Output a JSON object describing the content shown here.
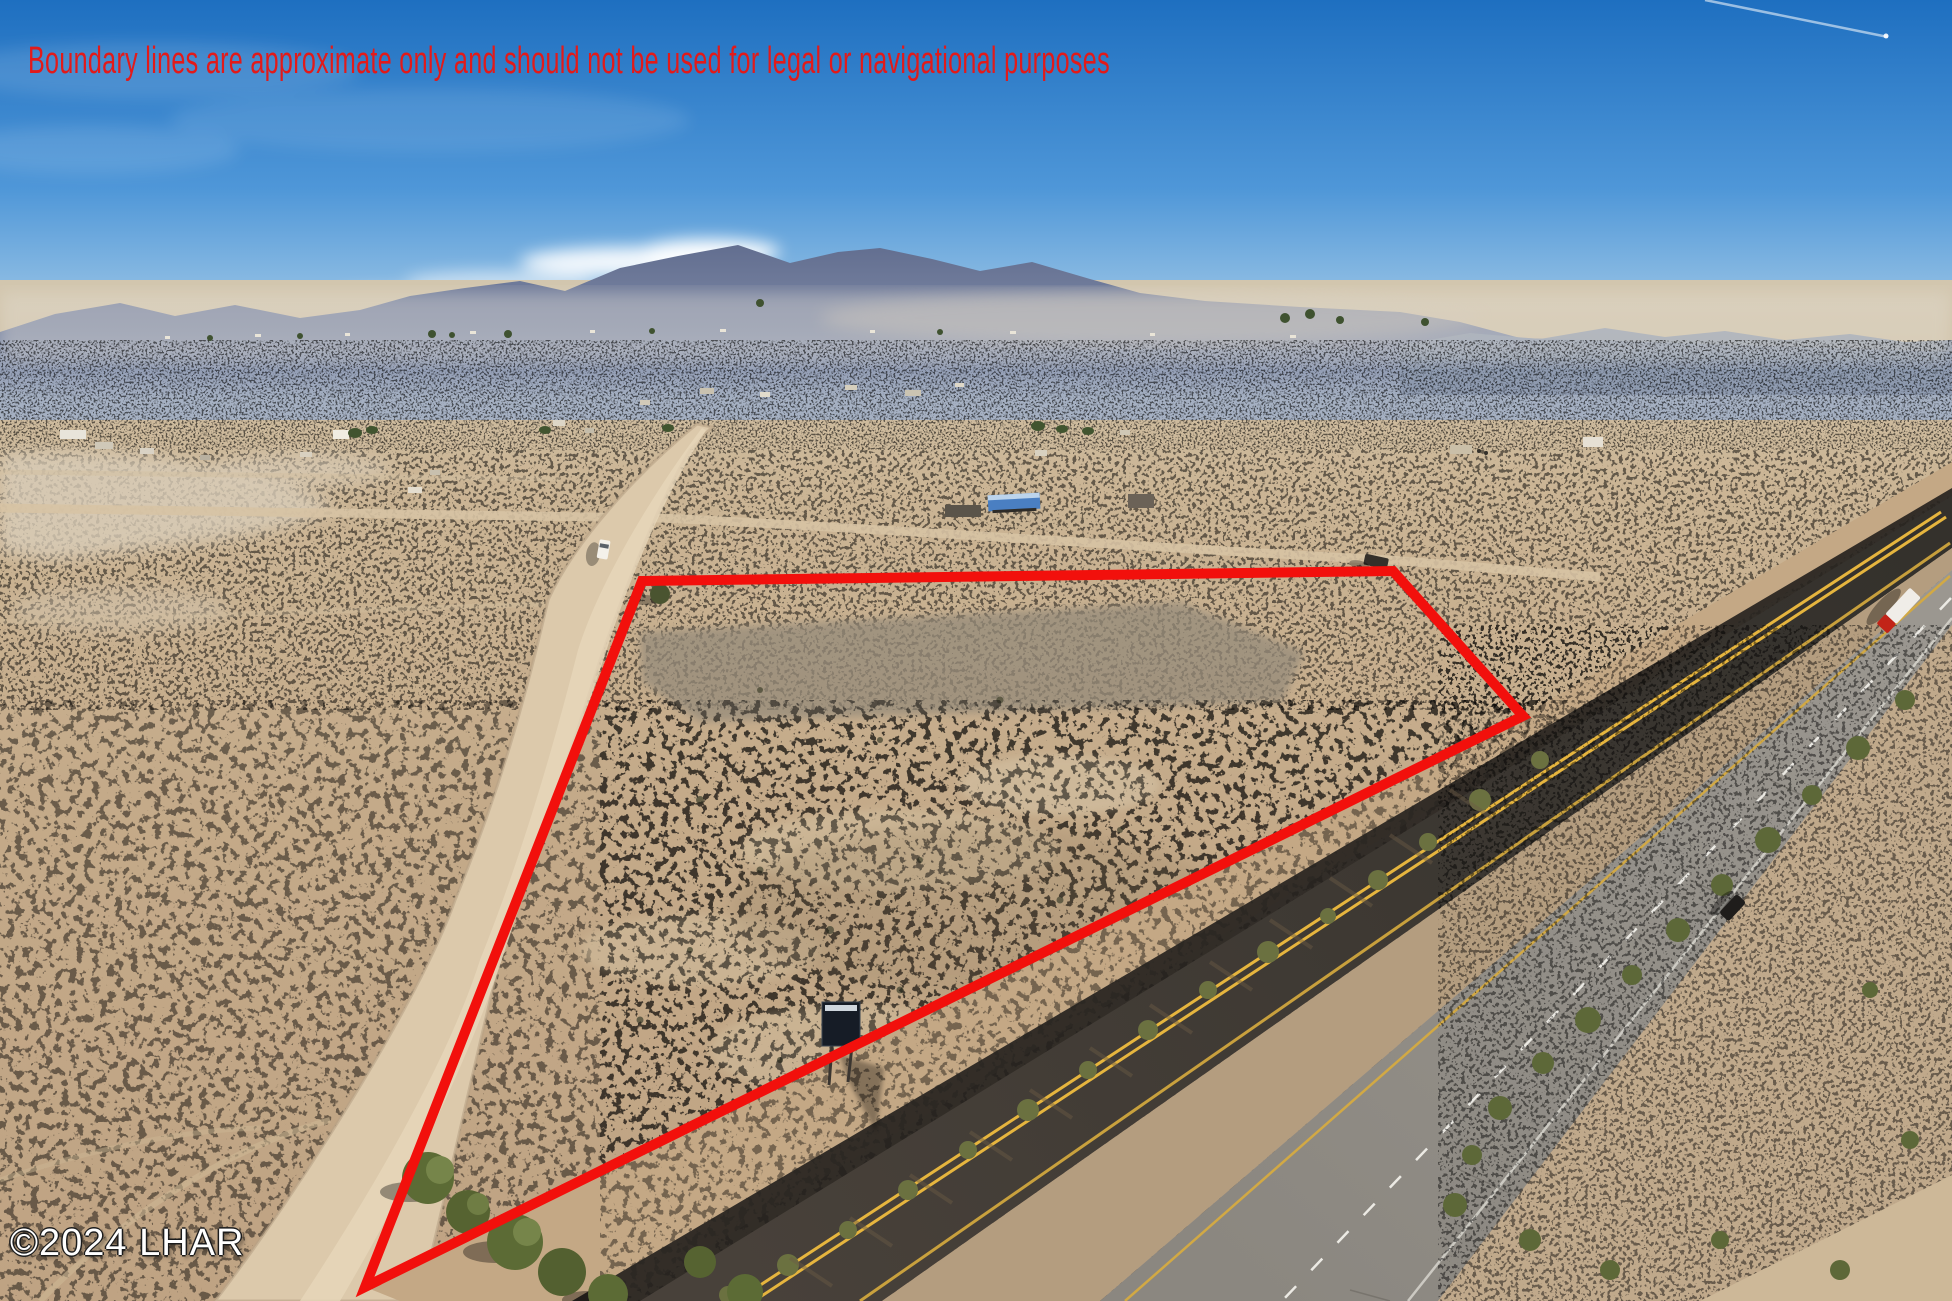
{
  "meta": {
    "type": "aerial-drone-photo",
    "description": "Aerial real-estate photo of a vacant desert land parcel outlined in red, beside a divided highway, with a dirt road, scattered rural homes and hazy mountains on the horizon"
  },
  "overlays": {
    "disclaimer": {
      "text": "Boundary lines are approximate only and should not be used for legal or navigational purposes",
      "color": "#e21a1a"
    },
    "watermark": {
      "text": "©2024 LHAR",
      "color": "#ffffff"
    },
    "boundary": {
      "points": "642,581 1393,571 1523,716 365,1287",
      "color": "#f2100c",
      "stroke_width": "10"
    }
  },
  "scene": {
    "sky": {
      "top_color": "#1e6fc0",
      "horizon_color": "#e3edf2",
      "features": [
        "wispy white cloud left of center",
        "thin jet contrail upper right"
      ]
    },
    "mountains": {
      "color": "#6d7894",
      "description": "hazy blue-purple desert mountain range along horizon, tallest peaks left of center"
    },
    "desert": {
      "far_color": "#cfc2aa",
      "near_color": "#bfa383"
    },
    "parcel": {
      "description": "vacant triangular desert parcel outlined in red between dirt road and highway",
      "boundary_color": "#f2100c"
    },
    "dirt_road": {
      "description": "wide graded dirt road running from horizon town to lower-left corner",
      "color": "#dcc9ab"
    },
    "cross_track": {
      "description": "faint dirt track crossing mid-field toward the highway"
    },
    "highway": {
      "description": "divided highway running diagonally on the right side",
      "near_asphalt": "#3e3a35",
      "far_asphalt": "#908c85",
      "center_line": "double yellow",
      "lane_line": "dashed white"
    },
    "vehicles": [
      {
        "label": "semi truck with red cab and white box trailer",
        "location": "far carriageway, upper right"
      },
      {
        "label": "dark car",
        "location": "far carriageway, middle right"
      },
      {
        "label": "white vehicle",
        "location": "dirt road, upper middle"
      },
      {
        "label": "dark parked vehicle",
        "location": "north-east boundary corner"
      }
    ],
    "structures": [
      {
        "label": "blue canopy building",
        "color": "#4a7fc2"
      },
      {
        "label": "scattered homes, trailers and sheds along distant band"
      },
      {
        "label": "small dark sign inside parcel near highway"
      }
    ],
    "vegetation": {
      "label": "green tamarisk bushes near parcel tip and along highway shoulders"
    }
  }
}
